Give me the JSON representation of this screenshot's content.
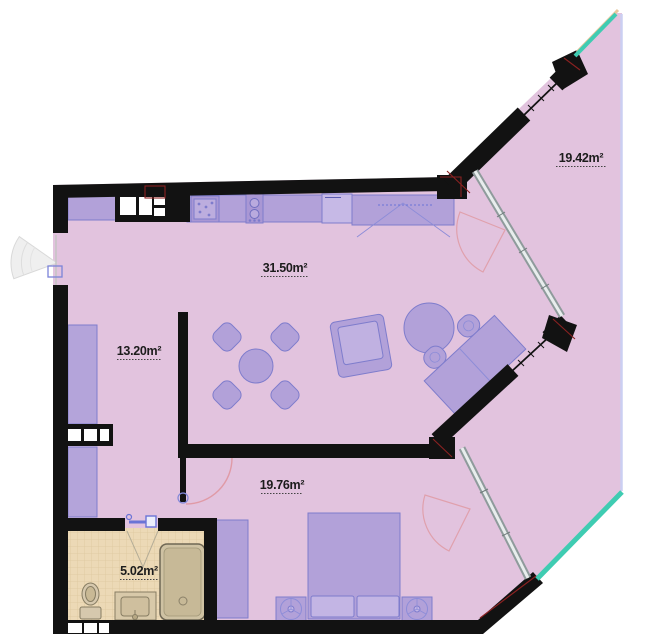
{
  "plan_type": "apartment-floor-plan",
  "rooms": [
    {
      "name": "living-room-kitchen",
      "area": "31.50m²"
    },
    {
      "name": "terrace",
      "area": "19.42m²"
    },
    {
      "name": "hallway",
      "area": "13.20m²"
    },
    {
      "name": "bedroom",
      "area": "19.76m²"
    },
    {
      "name": "bathroom",
      "area": "5.02m²"
    }
  ],
  "furniture": {
    "kitchen": [
      "cabinet",
      "sink",
      "stove",
      "refrigerator",
      "wardrobe"
    ],
    "living_room": [
      "dining-table",
      "four-chairs",
      "armchair",
      "ottoman",
      "desk",
      "two-desk-chairs"
    ],
    "bedroom": [
      "double-bed",
      "two-pillows",
      "nightstand-left",
      "nightstand-right",
      "table-lamps",
      "wardrobe"
    ],
    "bathroom": [
      "toilet",
      "washbasin",
      "shower"
    ],
    "hallway": [
      "wardrobe-upper",
      "wardrobe-lower"
    ]
  },
  "openings": {
    "entrance_door": "left-wall",
    "bedroom_door": "inner-wall",
    "bathroom_door": "bathroom-front-wall",
    "balcony_door_living": "glass-partition-upper",
    "balcony_door_bedroom": "glass-partition-lower",
    "windows": [
      "upper-diagonal-wall",
      "lower-diagonal-wall"
    ]
  },
  "colors": {
    "floor_pink": "#e2c3de",
    "wall_black": "#121212",
    "furniture_purple": "#b2a1d9",
    "furniture_stroke": "#7e7ccc",
    "bathroom_floor_tan": "#ecd9b6",
    "bathroom_tile_line": "#dcc79e",
    "balcony_glass_teal": "#3fccb2",
    "glass_frame_tan": "#e7c89e",
    "edge_periwinkle": "#cbcff2",
    "partition_gray": "#8f9b9c",
    "door_arc_pink": "#e0a0ac",
    "accent_red": "#8b2121"
  }
}
